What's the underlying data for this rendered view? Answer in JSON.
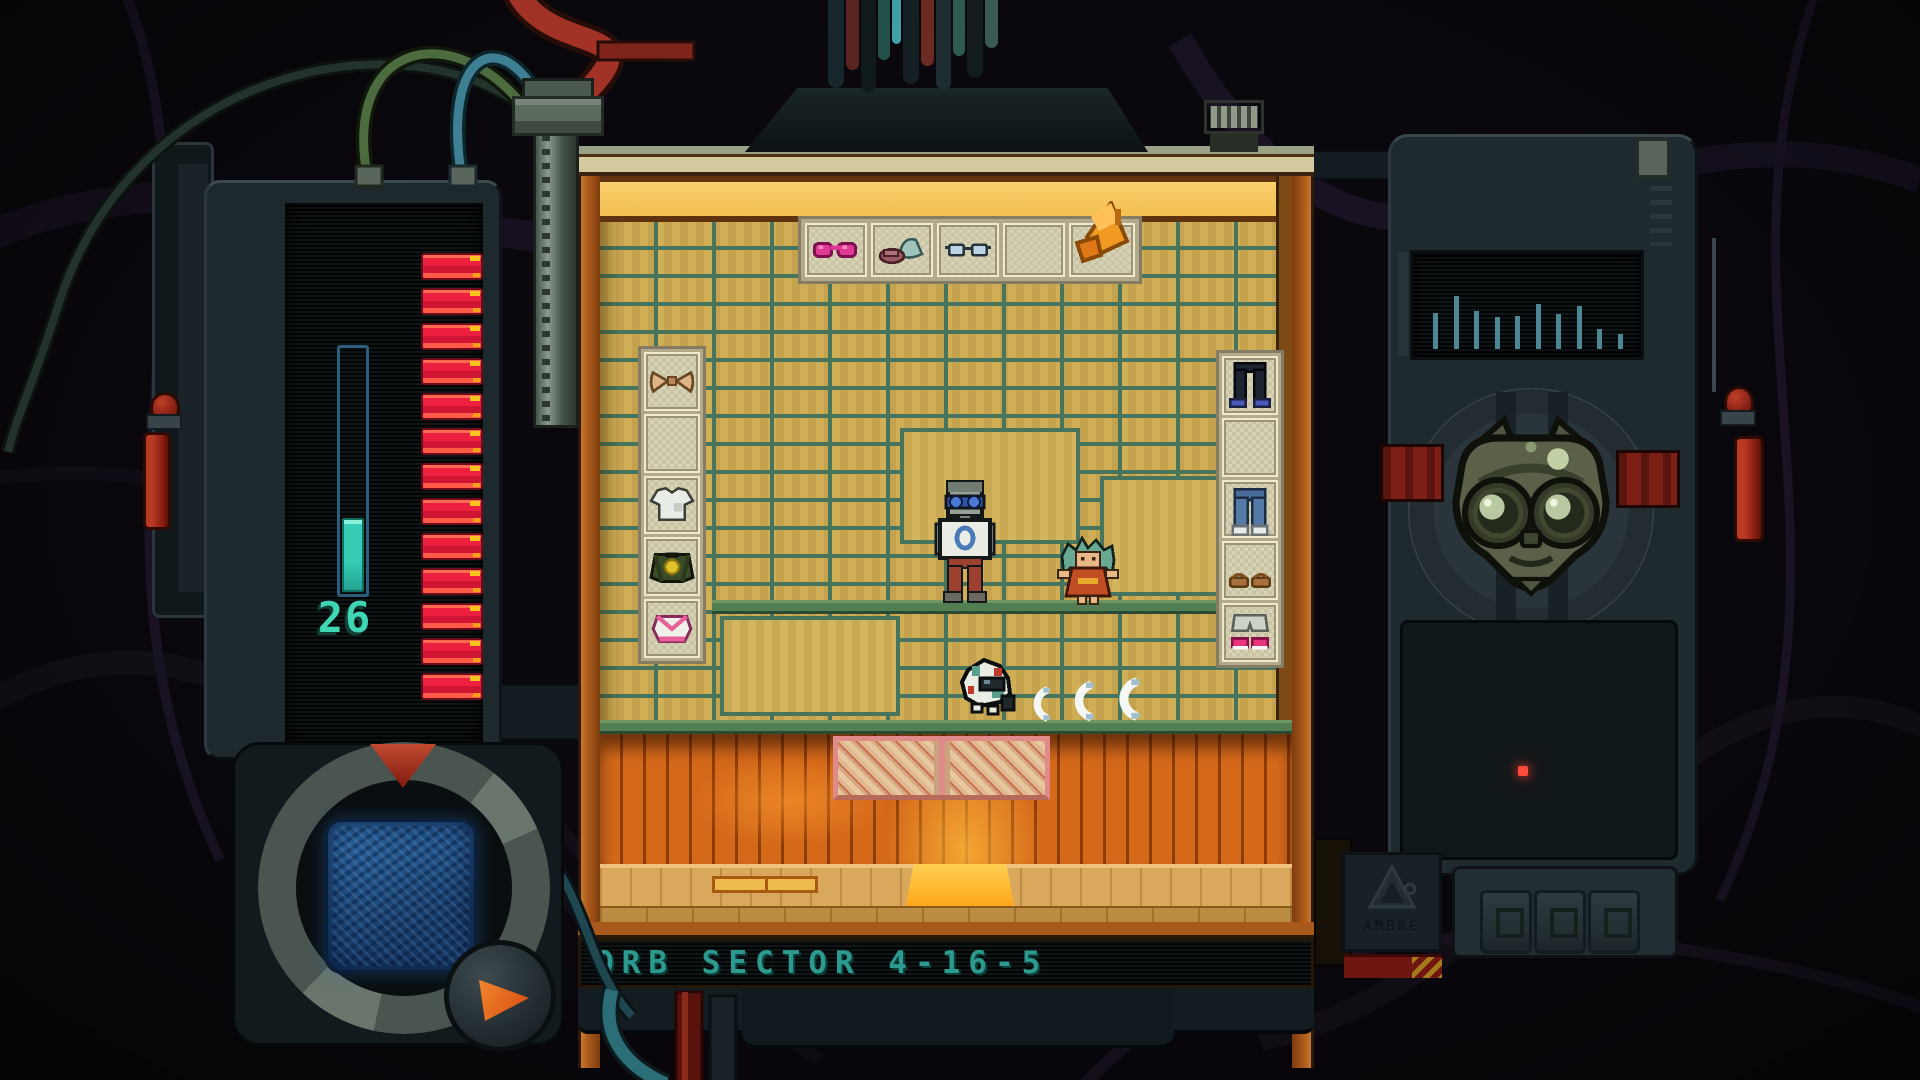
{
  "left_panel": {
    "counter": {
      "value": "26",
      "color": "#3fd6b4"
    },
    "gauge": {
      "fill_ratio": 0.3,
      "tube_color": "#2d5d7c",
      "fill_color": "#35cbb5"
    },
    "charge_segments": {
      "count": 13,
      "color": "#ee2040",
      "accent": "#ffc31e"
    }
  },
  "status_bar": {
    "label": "ORB SECTOR 4-16-5",
    "color": "#2d9a90"
  },
  "shop_scene": {
    "top_shelf_items": [
      "pink-sunglasses",
      "teal-and-mauve-hats",
      "blue-glasses",
      "empty",
      "orange-megaphone"
    ],
    "left_rack_items": [
      "tan-bow-top",
      "empty",
      "white-tshirt",
      "green-varsity-jacket",
      "white-pink-top"
    ],
    "right_rack_items": [
      "black-pants-blue-shoes",
      "empty",
      "blue-jeans-white-shoes",
      "brown-sandals",
      "grey-shorts-pink-sneakers"
    ],
    "characters": [
      "goggle-visitor",
      "red-dress-npc",
      "small-companion-critter"
    ],
    "effect_marks": {
      "shape": "crescent",
      "count": 3
    }
  },
  "right_panel": {
    "visualizer": {
      "bar_color": "#4e8794",
      "bar_heights": [
        36,
        53,
        38,
        32,
        33,
        45,
        35,
        43,
        20,
        15
      ]
    },
    "status_led": {
      "color": "#ff4a3c"
    },
    "badge": {
      "logo": "mountain-triangle",
      "text": "AMBRE"
    },
    "keys": {
      "count": 3
    }
  }
}
